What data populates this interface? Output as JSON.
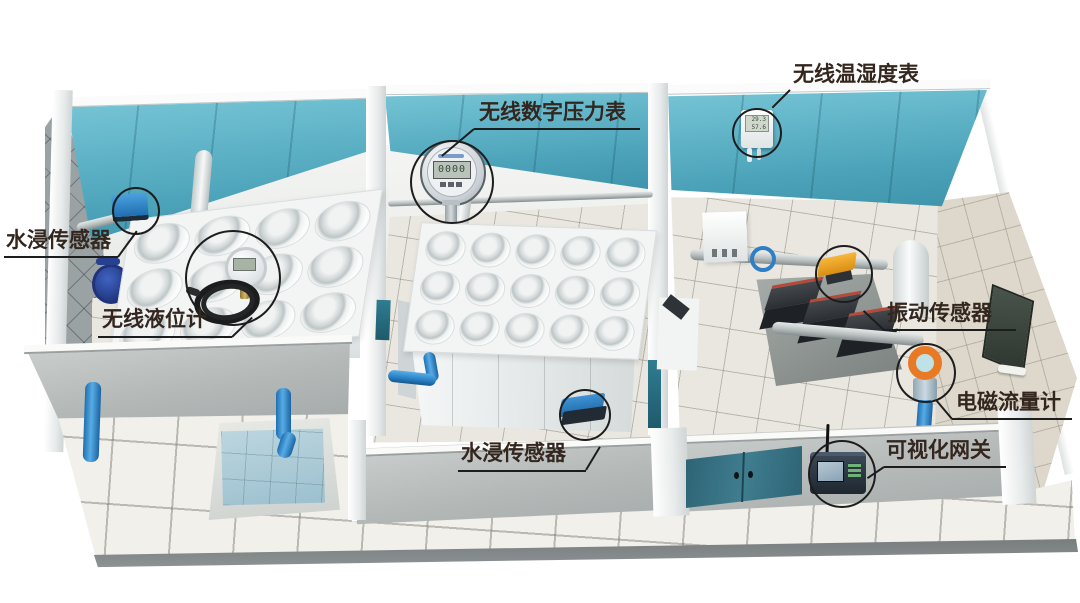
{
  "annotations": [
    {
      "id": "water-immersion-sensor-left",
      "label": "水浸传感器"
    },
    {
      "id": "wireless-level-gauge",
      "label": "无线液位计"
    },
    {
      "id": "wireless-digital-pressure-gauge",
      "label": "无线数字压力表"
    },
    {
      "id": "wireless-temp-humidity-meter",
      "label": "无线温湿度表"
    },
    {
      "id": "vibration-sensor",
      "label": "振动传感器"
    },
    {
      "id": "electromagnetic-flowmeter",
      "label": "电磁流量计"
    },
    {
      "id": "visualization-gateway",
      "label": "可视化网关"
    },
    {
      "id": "water-immersion-sensor-floor",
      "label": "水浸传感器"
    }
  ],
  "device_readings": {
    "pressure_gauge_lcd": "0000",
    "temp_humidity_lcd_line1": "29.3",
    "temp_humidity_lcd_line2": "57.6"
  },
  "colors": {
    "ceiling_teal": "#5bb3c7",
    "pipe_blue": "#2f8fd2",
    "sensor_box_blue": "#2a7fc0",
    "vibration_sensor_yellow": "#f0a11c",
    "flowmeter_orange": "#e87a25",
    "door_teal": "#33707f",
    "label_text": "#33261e",
    "floor_tile": "#e9e7e0",
    "front_wall_grey": "#c2c6c5"
  }
}
